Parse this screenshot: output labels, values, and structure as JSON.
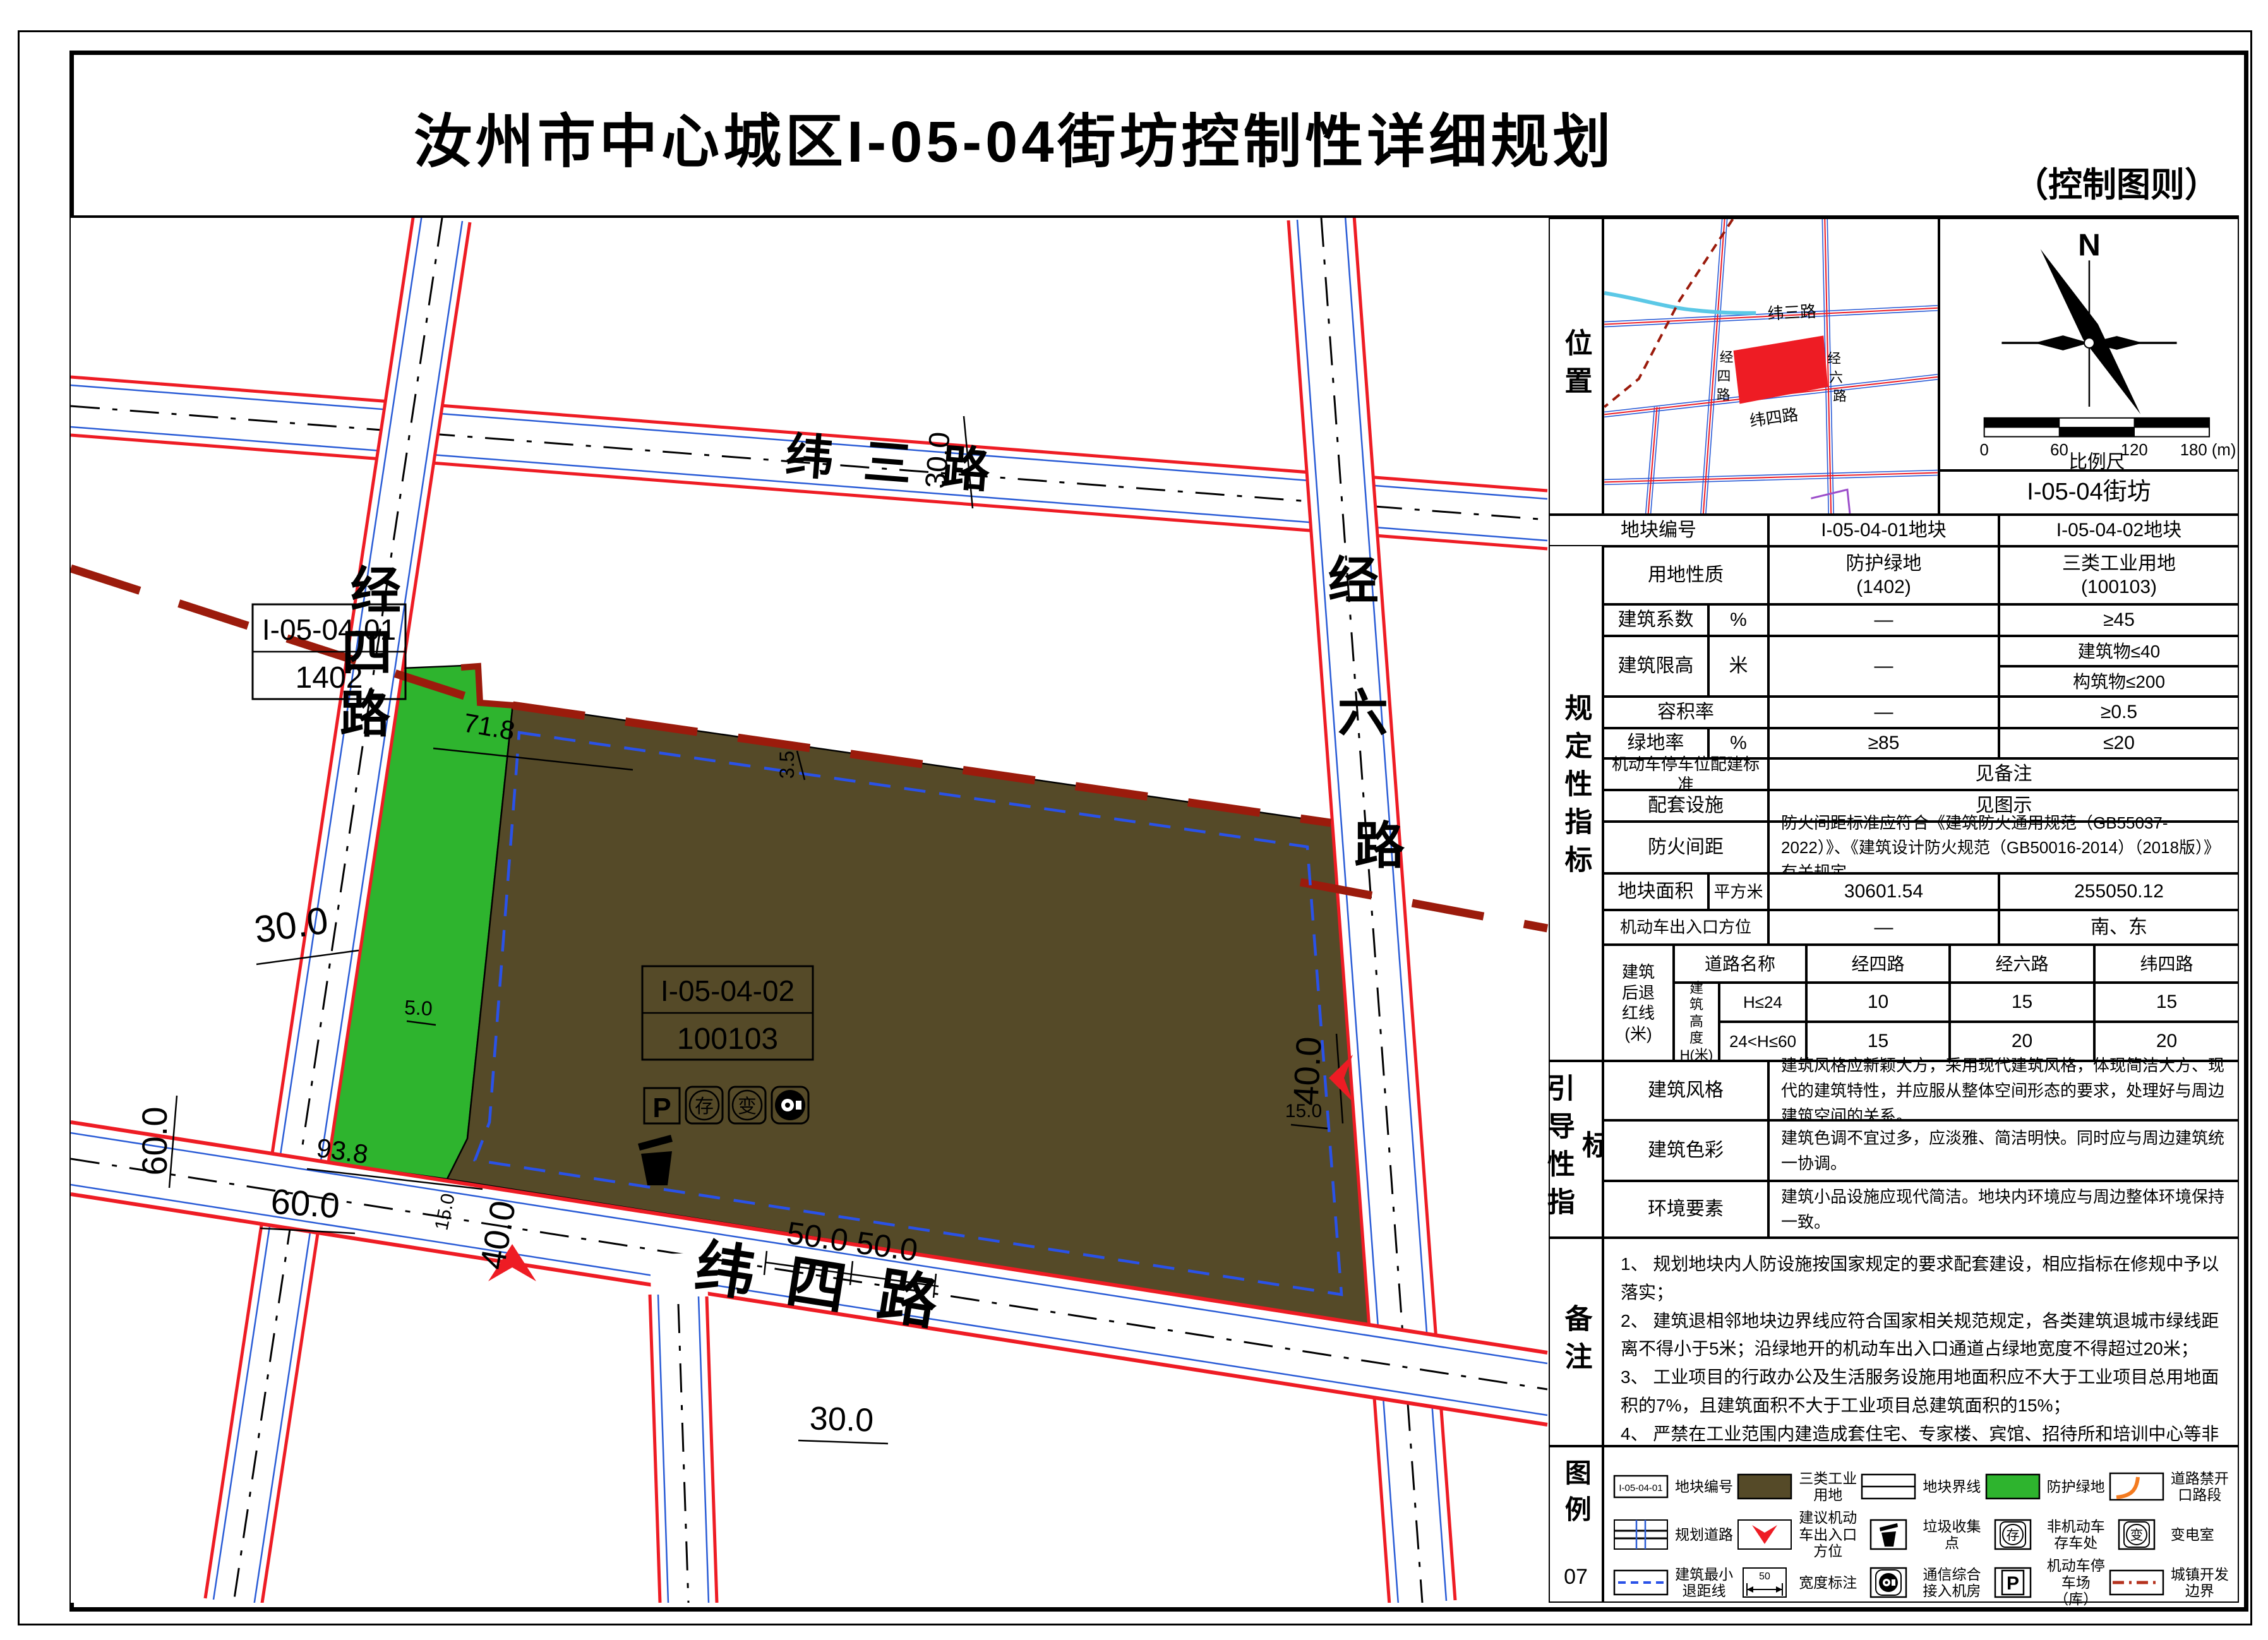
{
  "title": "汝州市中心城区I-05-04街坊控制性详细规划",
  "subtitle": "（控制图则）",
  "location": {
    "side_label": "位置",
    "north": "N",
    "block": "I-05-04街坊",
    "scale": {
      "t0": "0",
      "t1": "60",
      "t2": "120",
      "t3": "180 (m)",
      "label": "比例尺"
    },
    "minimap": {
      "weisan": "纬三路",
      "weisi": "纬四路",
      "jingsi": [
        "经",
        "四",
        "路"
      ],
      "jingliu": [
        "经",
        "六",
        "路"
      ]
    }
  },
  "reg": {
    "side_label": "规定性指标",
    "header": {
      "label": "地块编号",
      "c1": "I-05-04-01地块",
      "c2": "I-05-04-02地块"
    },
    "landuse": {
      "label": "用地性质",
      "c1": "防护绿地\n(1402)",
      "c2": "三类工业用地\n(100103)"
    },
    "coeff": {
      "label": "建筑系数",
      "unit": "%",
      "c1": "—",
      "c2": "≥45"
    },
    "height": {
      "label": "建筑限高",
      "unit": "米",
      "c1": "—",
      "c2a": "建筑物≤40",
      "c2b": "构筑物≤200"
    },
    "far": {
      "label": "容积率",
      "c1": "—",
      "c2": "≥0.5"
    },
    "green": {
      "label": "绿地率",
      "unit": "%",
      "c1": "≥85",
      "c2": "≤20"
    },
    "parking": {
      "label": "机动车停车位配建标准",
      "value": "见备注"
    },
    "facility": {
      "label": "配套设施",
      "value": "见图示"
    },
    "fire": {
      "label": "防火间距",
      "value": "防火间距标准应符合《建筑防火通用规范（GB55037-2022）》、《建筑设计防火规范（GB50016-2014）（2018版）》有关规定。"
    },
    "area": {
      "label": "地块面积",
      "unit": "平方米",
      "c1": "30601.54",
      "c2": "255050.12"
    },
    "entry": {
      "label": "机动车出入口方位",
      "c1": "—",
      "c2": "南、东"
    },
    "setback": {
      "label": "建筑\n后退\n红线\n(米)",
      "road_header": "道路名称",
      "height_label": "建\n筑\n高\n度\nH(米)",
      "r1_label": "H≤24",
      "r2_label": "24<H≤60",
      "roads": [
        "经四路",
        "经六路",
        "纬四路"
      ],
      "r1": [
        "10",
        "15",
        "15"
      ],
      "r2": [
        "15",
        "20",
        "20"
      ]
    }
  },
  "guide": {
    "side_label": "引导性指标",
    "rows": [
      {
        "label": "建筑风格",
        "text": "建筑风格应新颖大方，采用现代建筑风格，体现简洁大方、现代的建筑特性，并应服从整体空间形态的要求，处理好与周边建筑空间的关系。"
      },
      {
        "label": "建筑色彩",
        "text": "建筑色调不宜过多，应淡雅、简洁明快。同时应与周边建筑统一协调。"
      },
      {
        "label": "环境要素",
        "text": "建筑小品设施应现代简洁。地块内环境应与周边整体环境保持一致。"
      }
    ]
  },
  "notes": {
    "side_label": "备注",
    "items": [
      "1、 规划地块内人防设施按国家规定的要求配套建设，相应指标在修规中予以落实；",
      "2、 建筑退相邻地块边界线应符合国家相关规范规定，各类建筑退城市绿线距离不得小于5米；沿绿地开的机动车出入口通道占绿地宽度不得超过20米；",
      "3、 工业项目的行政办公及生活服务设施用地面积应不大于工业项目总用地面积的7%，且建筑面积不大于工业项目总建筑面积的15%；",
      "4、 严禁在工业范围内建造成套住宅、专家楼、宾馆、招待所和培训中心等非生产性配套设施；",
      "5、 三类工业用地机动车停车位、非机动车停车位配建按照相关规范进行合理配建；",
      "6、 本次规划采用2000国家大地坐标系进行控制。"
    ]
  },
  "legend": {
    "side_label": "图例",
    "page_number": "07",
    "items": [
      {
        "icon": "parcel-code",
        "label": "地块编号",
        "sample": "I-05-04-01"
      },
      {
        "icon": "industrial-swatch",
        "label": "三类工业用地"
      },
      {
        "icon": "parcel-boundary",
        "label": "地块界线"
      },
      {
        "icon": "green-swatch",
        "label": "防护绿地"
      },
      {
        "icon": "no-opening",
        "label": "道路禁开口路段"
      },
      {
        "icon": "planned-road",
        "label": "规划道路"
      },
      {
        "icon": "entry-arrow",
        "label": "建议机动车出入口方位"
      },
      {
        "icon": "trash",
        "label": "垃圾收集点"
      },
      {
        "icon": "bike-storage",
        "label": "非机动车存车处",
        "glyph": "存"
      },
      {
        "icon": "substation",
        "label": "变电室",
        "glyph": "变"
      },
      {
        "icon": "min-setback",
        "label": "建筑最小退距线"
      },
      {
        "icon": "width-note",
        "label": "宽度标注",
        "sample": "50"
      },
      {
        "icon": "telecom",
        "label": "通信综合接入机房"
      },
      {
        "icon": "parking",
        "label": "机动车停车场（库）",
        "glyph": "P"
      },
      {
        "icon": "dev-boundary",
        "label": "城镇开发边界"
      }
    ]
  },
  "map": {
    "h_roads": [
      {
        "name": "纬三路"
      },
      {
        "name": "纬四路"
      }
    ],
    "v_roads": [
      {
        "name": "经四路",
        "chars": [
          "经",
          "四",
          "路"
        ]
      },
      {
        "name": "经六路",
        "chars": [
          "经",
          "六",
          "路"
        ]
      }
    ],
    "parcels": [
      {
        "code": "I-05-04-01",
        "use_code": "1402"
      },
      {
        "code": "I-05-04-02",
        "use_code": "100103"
      }
    ],
    "icons": {
      "p": "P",
      "cun": "存",
      "bian": "变"
    },
    "dims": [
      {
        "t": "30.0"
      },
      {
        "t": "30.0"
      },
      {
        "t": "60.0"
      },
      {
        "t": "60.0"
      },
      {
        "t": "93.8"
      },
      {
        "t": "71.8"
      },
      {
        "t": "40.0"
      },
      {
        "t": "40.0"
      },
      {
        "t": "50.0 50.0"
      },
      {
        "t": "30.0"
      },
      {
        "t": "15.0"
      },
      {
        "t": "15.0"
      },
      {
        "t": "5.0"
      },
      {
        "t": "3.5"
      }
    ]
  },
  "colors": {
    "road_red": "#ee1c24",
    "road_blue": "#2a5cd6",
    "green_parcel": "#2eb42e",
    "industrial_brown": "#554a28",
    "dev_boundary": "#9b1b0c",
    "setback_blue": "#2a52e8",
    "no_opening_orange": "#f47b20",
    "river_cyan": "#5bc8e6",
    "purple_line": "#9b4dca"
  }
}
